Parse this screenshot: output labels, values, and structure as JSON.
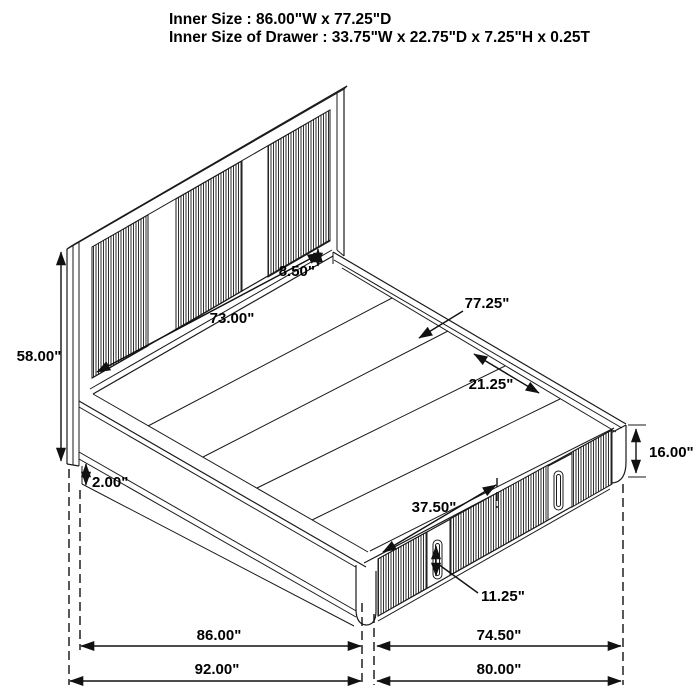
{
  "header": {
    "inner_size": "Inner Size : 86.00\"W x 77.25\"D",
    "inner_drawer_size": "Inner Size of Drawer : 33.75\"W x 22.75\"D x 7.25\"H x 0.25T"
  },
  "dimensions": {
    "headboard_height": "58.00\"",
    "headboard_panel_width": "73.00\"",
    "headboard_rail_gap": "8.50\"",
    "platform_depth": "77.25\"",
    "slat_section": "21.25\"",
    "base_reveal": "2.00\"",
    "footboard_height": "16.00\"",
    "drawer_front_width": "37.50\"",
    "drawer_handle_height": "11.25\"",
    "side_rail_length": "86.00\"",
    "footboard_inner_width": "74.50\"",
    "overall_length": "92.00\"",
    "overall_width": "80.00\""
  },
  "colors": {
    "line": "#1a1a1a",
    "text": "#000000",
    "background": "#ffffff",
    "flute_stripe": "#2e2e2e"
  }
}
